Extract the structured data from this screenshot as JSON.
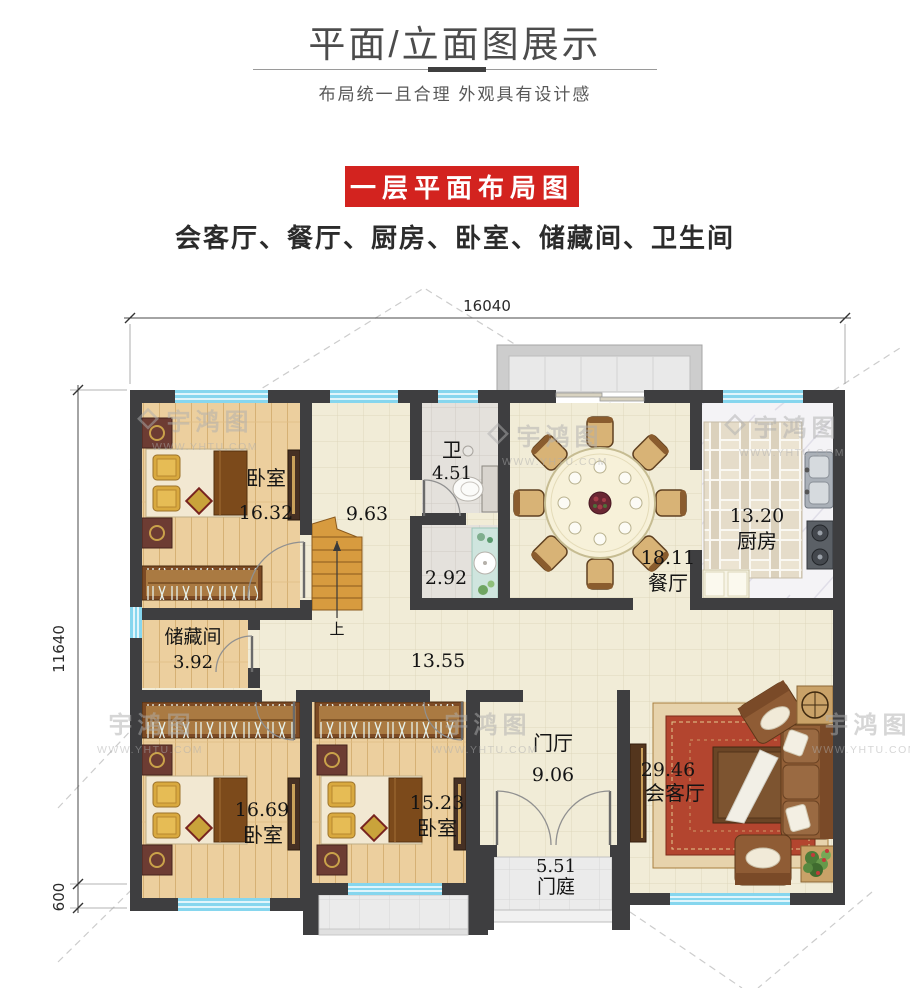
{
  "header": {
    "title": "平面/立面图展示",
    "subtitle": "布局统一且合理  外观具有设计感"
  },
  "banner": {
    "label": "一层平面布局图",
    "bg_color": "#d3231f",
    "text_color": "#ffffff"
  },
  "features_line": "会客厅、餐厅、厨房、卧室、储藏间、卫生间",
  "plan": {
    "dimensions": {
      "width_total": "16040",
      "height_main": "11640",
      "height_step": "600"
    },
    "rooms": {
      "bedroom_tl": {
        "name": "卧室",
        "area": "16.32"
      },
      "stair_hall": {
        "area": "9.63"
      },
      "bathroom": {
        "name": "卫",
        "area": "4.51"
      },
      "washroom": {
        "area": "2.92"
      },
      "dining": {
        "name": "餐厅",
        "area": "18.11"
      },
      "kitchen": {
        "name": "厨房",
        "area": "13.20"
      },
      "storage": {
        "name": "储藏间",
        "area": "3.92"
      },
      "corridor": {
        "area": "13.55"
      },
      "bedroom_bl": {
        "name": "卧室",
        "area": "16.69"
      },
      "bedroom_bm": {
        "name": "卧室",
        "area": "15.23"
      },
      "entry_hall": {
        "name": "门厅",
        "area": "9.06"
      },
      "living": {
        "name": "会客厅",
        "area": "29.46"
      },
      "porch": {
        "name": "门庭",
        "area": "5.51"
      }
    },
    "stairs": {
      "direction_label": "上"
    },
    "wall_color": "#3e3e40",
    "window_color": "#86d6ee"
  },
  "watermark": {
    "brand": "宇鸿图",
    "site": "WWW.YHTU.COM"
  }
}
